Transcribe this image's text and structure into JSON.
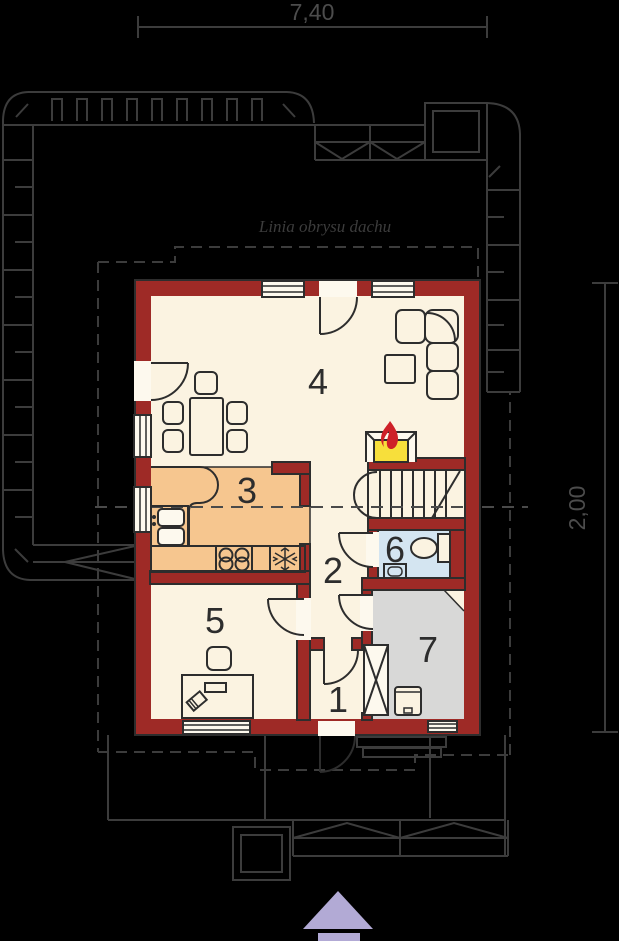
{
  "dimensions": {
    "top": "7,40",
    "right": "2,00"
  },
  "roof_label": "Linia obrysu dachu",
  "rooms": [
    "1",
    "2",
    "3",
    "4",
    "5",
    "6",
    "7"
  ],
  "colors": {
    "wall_red": "#9e2a26",
    "ink": "#2d2d2d",
    "floor_cream": "#fbf3e1",
    "gap_white": "#fdf9ee",
    "kitchen_orange": "#f6c68f",
    "bath_blue": "#d4e5f1",
    "utility_gray": "#d8d8d7",
    "fire_yellow": "#f7df3b",
    "flame_red": "#ce2028",
    "arrow_purple": "#b2aad5",
    "site_line": "#3c3c3c",
    "dim_text": "#4c4c4c",
    "background": "#000000"
  }
}
